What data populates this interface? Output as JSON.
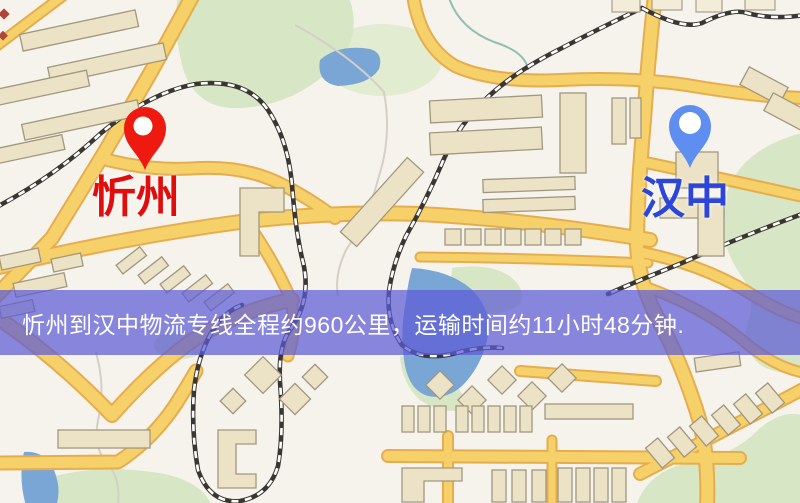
{
  "map": {
    "markers": [
      {
        "name": "origin",
        "label": "忻州",
        "pin_color": "#ee1a10",
        "pin_inner_color": "#ffffff",
        "label_color": "#e00d0d",
        "pin_style": "red-location-pin"
      },
      {
        "name": "destination",
        "label": "汉中",
        "pin_color": "#5f8ef1",
        "pin_inner_color": "#ffffff",
        "label_color": "#2b46d8",
        "pin_style": "blue-location-pin"
      }
    ],
    "palette": {
      "land": "#f6f3ed",
      "road": "#f6d069",
      "road_casing": "#e6ad4e",
      "railway": "#3a3632",
      "building": "#ece3c6",
      "park": "#d7e6c4",
      "water": "#7aa6d6"
    }
  },
  "banner": {
    "text": "忻州到汉中物流专线全程约960公里，运输时间约11小时48分钟.",
    "background_color": "#5c5cd6",
    "text_color": "#ffffff",
    "route": {
      "origin": "忻州",
      "destination": "汉中",
      "distance": "约960公里",
      "duration": "约11小时48分钟"
    }
  }
}
